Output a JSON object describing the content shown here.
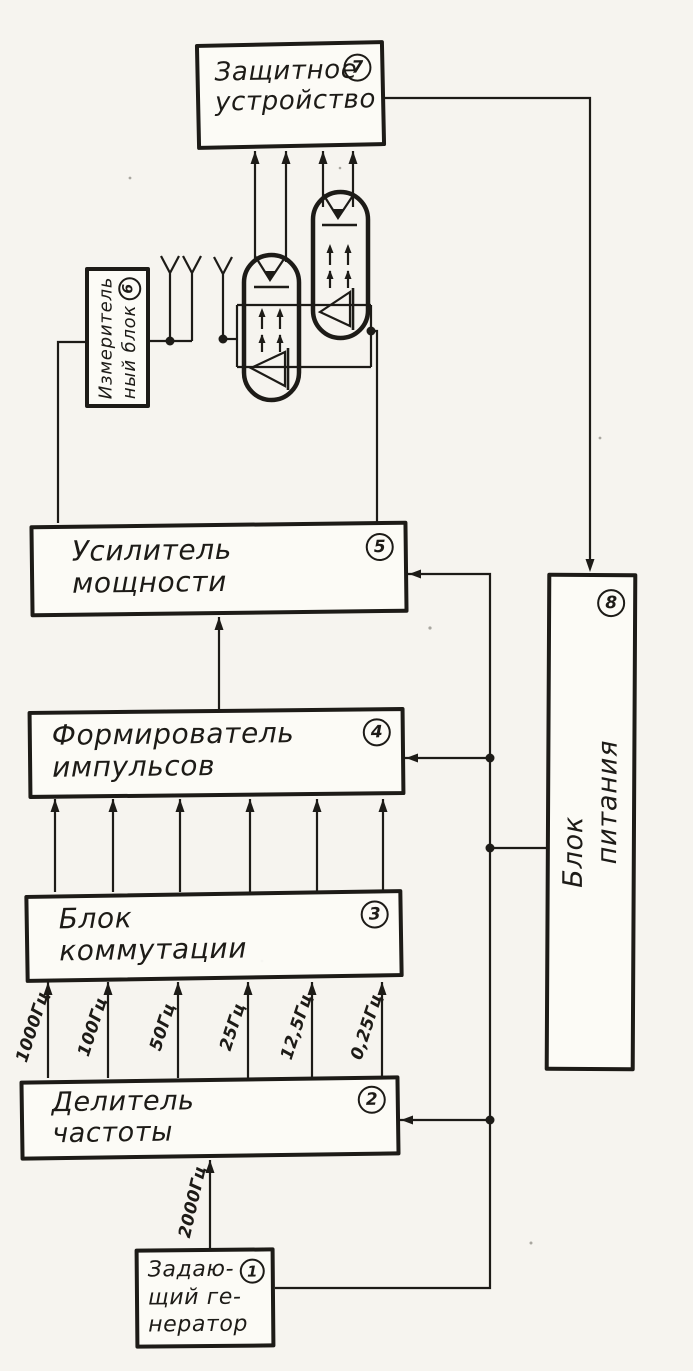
{
  "palette": {
    "paper": "#f6f4ef",
    "ink": "#1d1b17"
  },
  "blocks": {
    "master_oscillator": {
      "number": "1",
      "lines": [
        "Задаю-",
        "щий ге-",
        "нератор"
      ]
    },
    "frequency_divider": {
      "number": "2",
      "lines": [
        "Делитель",
        "частоты"
      ]
    },
    "switching_block": {
      "number": "3",
      "lines": [
        "Блок",
        "коммутации"
      ]
    },
    "pulse_shaper": {
      "number": "4",
      "lines": [
        "Формирователь",
        "импульсов"
      ]
    },
    "power_amplifier": {
      "number": "5",
      "lines": [
        "Усилитель",
        "мощности"
      ]
    },
    "measuring_block": {
      "number": "6",
      "lines": [
        "Измеритель",
        "ный блок"
      ]
    },
    "protective_device": {
      "number": "7",
      "lines": [
        "Защитное",
        "устройство"
      ]
    },
    "power_supply": {
      "number": "8",
      "lines": [
        "Блок",
        "питания"
      ]
    }
  },
  "signals": {
    "oscillator_output": "2000Гц",
    "divider_outputs": [
      "1000Гц",
      "100Гц",
      "50Гц",
      "25Гц",
      "12,5Гц",
      "0,25Гц"
    ]
  }
}
